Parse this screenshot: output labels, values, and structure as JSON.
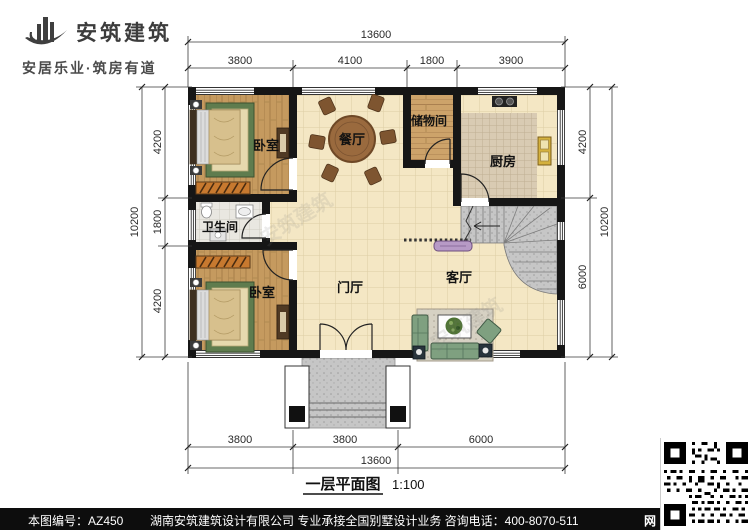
{
  "logo": {
    "company_name": "安筑建筑",
    "tagline": "安居乐业·筑房有道"
  },
  "plan": {
    "rooms": [
      {
        "id": "bedroom-top",
        "label": "卧室"
      },
      {
        "id": "dining",
        "label": "餐厅"
      },
      {
        "id": "storage",
        "label": "储物间"
      },
      {
        "id": "kitchen",
        "label": "厨房"
      },
      {
        "id": "bathroom",
        "label": "卫生间"
      },
      {
        "id": "bedroom-bottom",
        "label": "卧室"
      },
      {
        "id": "foyer",
        "label": "门厅"
      },
      {
        "id": "living",
        "label": "客厅"
      }
    ]
  },
  "dimensions": {
    "top": {
      "total": "13600",
      "segments": [
        "3800",
        "4100",
        "1800",
        "3900"
      ]
    },
    "bottom": {
      "total": "13600",
      "segments": [
        "3800",
        "3800",
        "6000"
      ]
    },
    "left": {
      "total": "10200",
      "segments": [
        "4200",
        "1800",
        "4200"
      ]
    },
    "right": {
      "total": "10200",
      "segments": [
        "4200",
        "6000"
      ]
    }
  },
  "caption": {
    "title": "一层平面图",
    "scale": "1:100"
  },
  "footer": {
    "drawing_number": "本图编号：AZ450",
    "company_line": "湖南安筑建筑设计有限公司  专业承接全国别墅设计业务  咨询电话：400-8070-511",
    "web_badge": "网"
  },
  "watermark": {
    "text": "安筑建筑"
  },
  "colors": {
    "wall": "#161616",
    "floor_tile": "#f4e7c4",
    "wood": "#c59a5f",
    "footer_bar": "#0d0d0d"
  }
}
